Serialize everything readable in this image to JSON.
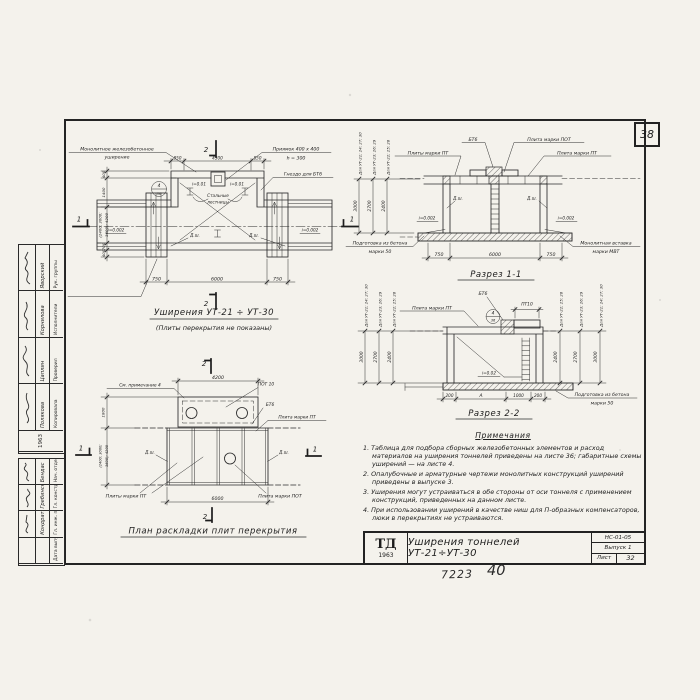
{
  "page": {
    "corner_sheet_number": "38",
    "footer_code": "7223",
    "footer_page": "40"
  },
  "title_block": {
    "logo": "ТД",
    "logo_year": "1963",
    "title": "Уширения тоннелей УТ-21÷УТ-30",
    "doc_code": "НС-01-05",
    "issue": "Выпуск 1",
    "sheet_label": "Лист",
    "sheet_number": "32"
  },
  "stamp": {
    "year": "1963",
    "upper": [
      {
        "role": "Рук. группы",
        "name": "Яворский"
      },
      {
        "role": "Исполнители",
        "name": "Корнилова"
      },
      {
        "role": "Проверил",
        "name": "Цаплин"
      },
      {
        "role": "Копировала",
        "name": "Полякова"
      }
    ],
    "lower": [
      {
        "role": "Нач. отдела",
        "name": "Бендас"
      },
      {
        "role": "Гл. конструктор",
        "name": "Гребинский"
      },
      {
        "role": "Гл. инж. пр.",
        "name": "Кондратьев"
      },
      {
        "role": "Дата выпуска",
        "name": ""
      }
    ]
  },
  "plan": {
    "title": "Уширения УТ-21 ÷ УТ-30",
    "subtitle": "(Плиты перекрытия не показаны)",
    "label_widening_1": "Монолитное железобетонное",
    "label_widening_2": "уширение",
    "label_pit_1": "Приямок 400 х 400",
    "label_pit_2": "h = 300",
    "label_socket": "Гнездо для БТ6",
    "label_ladders_1": "Стальные",
    "label_ladders_2": "лестницы",
    "label_insert_1": "Монолитная вставка",
    "label_insert_2": "марки МВТ",
    "slope_left": "i=0.002",
    "slope_right": "i=0.002",
    "slope_top_left": "i=0.01",
    "slope_top_right": "i=0.01",
    "joint": "Д.ш.",
    "detail_num": "4",
    "detail_sheet": "36",
    "dim_top_left": "850",
    "dim_top_center": "4300",
    "dim_top_right": "850",
    "dim_bottom_left": "750",
    "dim_bottom_center": "6000",
    "dim_bottom_right": "750",
    "dim_v1": "400",
    "dim_v2": "1400",
    "dim_v3a": "(2400; 3000;",
    "dim_v3b": "3600); 4200",
    "dim_v4": "700",
    "dim_v5": "400",
    "mark_section_2": "2",
    "mark_section_1": "1"
  },
  "section1": {
    "title": "Разрез 1-1",
    "label_bt6": "БТ6",
    "label_pot": "Плита марки ПОТ",
    "label_pt_right": "Плита марки ПТ",
    "label_pt_left": "Плиты марки ПТ",
    "label_prep_1": "Подготовка из бетона",
    "label_prep_2": "марки 50",
    "label_insert_1": "Монолитная вставка",
    "label_insert_2": "марки МВТ",
    "joint": "Д.ш.",
    "slope": "i=0.002",
    "dim_left": "750",
    "dim_center": "6000",
    "dim_right": "750",
    "heights": [
      {
        "label": "Для УТ-21; 24; 27; 30",
        "value": "3000"
      },
      {
        "label": "Для УТ-23; 26; 29",
        "value": "2700"
      },
      {
        "label": "Для УТ-22; 25; 28",
        "value": "2400"
      }
    ]
  },
  "section2": {
    "title": "Разрез 2-2",
    "label_pt": "Плита марки ПТ",
    "label_bt6": "БТ6",
    "label_pt10": "ПТ10",
    "slope": "i=0.02",
    "label_prep_1": "Подготовка из бетона",
    "label_prep_2": "марки 50",
    "detail_num": "4",
    "detail_sheet": "36",
    "dims": [
      "200",
      "А",
      "1000",
      "200"
    ],
    "heights_left": [
      {
        "label": "Для УТ-21; 24; 27; 30",
        "value": "3000"
      },
      {
        "label": "Для УТ-23; 26; 29",
        "value": "2700"
      },
      {
        "label": "Для УТ-22; 25; 28",
        "value": "2400"
      }
    ],
    "heights_right": [
      {
        "label": "Для УТ-22; 25; 28",
        "value": "2400"
      },
      {
        "label": "Для УТ-23; 26; 29",
        "value": "2700"
      },
      {
        "label": "Для УТ-21; 24; 27; 30",
        "value": "3000"
      }
    ]
  },
  "plan2": {
    "title": "План раскладки плит перекрытия",
    "label_note": "См. примечание 4",
    "label_pot10": "ПОТ 10",
    "label_bt6": "БТ6",
    "label_pt": "Плита марки ПТ",
    "label_pt_plural": "Плиты марки ПТ",
    "label_pot": "Плита марки ПОТ",
    "joint": "Д.ш.",
    "dim_top": "4200",
    "dim_bottom": "6000",
    "dim_left_upper": "1800",
    "dim_left_lower_a": "(2400; 3000;",
    "dim_left_lower_b": "3600); 4200",
    "mark_section_2": "2",
    "mark_section_1": "1"
  },
  "notes": {
    "title": "Примечания",
    "items": [
      "1. Таблица для подбора сборных железобетонных элементов и расход материалов на уширения тоннелей приведены на листе 36; габаритные схемы уширений — на листе 4.",
      "2. Опалубочные и арматурные чертежи монолитных конструкций уширений приведены в выпуске 3.",
      "3. Уширения могут устраиваться в обе стороны от оси тоннеля с применением конструкций, приведенных на данном листе.",
      "4. При использовании уширений в качестве ниш для П-образных компенсаторов, люки в перекрытиях не устраиваются."
    ]
  }
}
